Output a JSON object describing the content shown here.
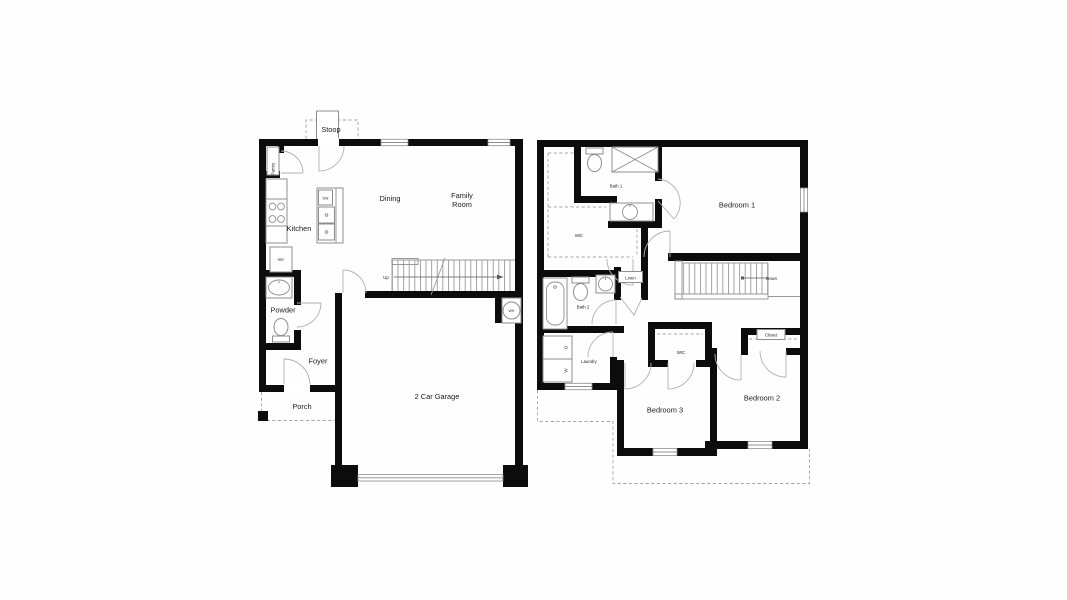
{
  "colors": {
    "background": "#ffffff",
    "wall": "#0c0c0c",
    "fixture_line": "#8d8d8d",
    "door_arc": "#b0b0b0",
    "dashed_line": "#a6a6a6",
    "text": "#1b1b1b"
  },
  "floor1": {
    "labels": {
      "stoop": "Stoop",
      "pantry": "Pantry",
      "kitchen": "Kitchen",
      "dining": "Dining",
      "family_room": [
        "Family",
        "Room"
      ],
      "powder": "Powder",
      "foyer": "Foyer",
      "porch": "Porch",
      "garage": "2 Car Garage",
      "ref": "REF",
      "dw": "DW",
      "wh": "WH",
      "up": "Up"
    }
  },
  "floor2": {
    "labels": {
      "bath1": "Bath 1",
      "bedroom1": "Bedroom 1",
      "wic": "WIC",
      "linen": "Linen",
      "bath2": "Bath 2",
      "laundry": "Laundry",
      "wic_bedroom3": "WIC",
      "closet": "Closet",
      "bedroom3": "Bedroom 3",
      "bedroom2": "Bedroom 2",
      "down": "Down",
      "dryer": "D",
      "washer": "W"
    }
  }
}
